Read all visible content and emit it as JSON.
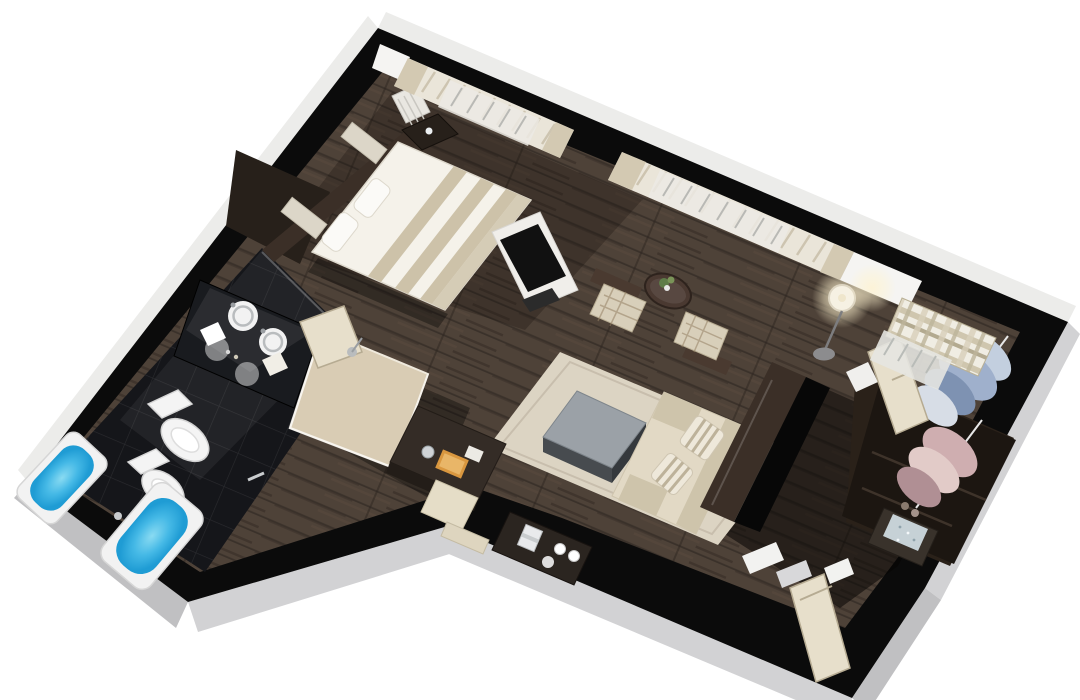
{
  "scene": {
    "description": "3D isometric cutaway floor plan render of a hotel suite apartment, rotated on white background",
    "rooms": [
      {
        "name": "bedroom",
        "furniture": [
          "double-bed-striped-duvet",
          "pillows",
          "headboard-panels",
          "nightstand-with-phone",
          "tv-stand",
          "radiator",
          "window-curtains"
        ]
      },
      {
        "name": "living-room",
        "furniture": [
          "area-rug",
          "coffee-table",
          "cream-sofa",
          "striped-pillows",
          "two-armchairs",
          "round-side-table-with-plant",
          "floor-lamp",
          "writing-desk",
          "desk-chair",
          "coffee-station-console",
          "media-wall-tv",
          "window-curtains"
        ]
      },
      {
        "name": "bathroom",
        "furniture": [
          "large-bathtub",
          "corner-bathtub",
          "toilet",
          "bidet",
          "double-round-sinks-vanity",
          "mirror",
          "towels"
        ]
      },
      {
        "name": "shower-room",
        "furniture": [
          "walk-in-shower",
          "glass-walls",
          "shower-door",
          "shower-head"
        ]
      },
      {
        "name": "dressing-room",
        "furniture": [
          "wardrobe",
          "hanging-blue-shirts",
          "hanging-pink-clothes",
          "safe",
          "plaid-window-curtain",
          "open-door"
        ]
      },
      {
        "name": "entry-hall",
        "furniture": [
          "entry-door",
          "dark-hallway-floor"
        ]
      }
    ]
  },
  "palette": {
    "bg": "#ffffff",
    "wall": "#0b0b0b",
    "face-light": "#ececea",
    "face-mid": "#d2d2d4",
    "face-dark": "#c0c0c2",
    "wood": "#4e4238",
    "wood-line": "#3a312a",
    "wood-light": "#5d4e42",
    "bath-tile": "#15161a",
    "water": "#45b9e6",
    "water-deep": "#1f9cd4",
    "fixture": "#f4f4f4",
    "shower-floor": "#d9ccb4",
    "door-cream": "#e7dfcb",
    "door-edge": "#b6ab92",
    "curtain": "#eae5d9",
    "curtain-fold": "#c8bfaa",
    "drape": "#d3c9b2",
    "white-wall": "#f5f4f2",
    "rug": "#dcd4c3",
    "rug-edge": "#c8bead",
    "sofa": "#e2d9c5",
    "sofa-shade": "#cec4ab",
    "stripe-tan": "#cdc2a9",
    "bed-white": "#f5f2ea",
    "table-top": "#9ba1a7",
    "table-side": "#474b4f",
    "brown-wall": "#3b2f27",
    "brown-dark": "#27201a",
    "lamp-glow": "#fff3cf",
    "orange": "#d9973f",
    "plant": "#5f7c49",
    "clothes-blue": "#9fb0cc",
    "clothes-blue-light": "#c3cfdf",
    "clothes-pink": "#cfaeb0",
    "clothes-pink-light": "#e2cbc8",
    "safe-top": "#c6d1d6",
    "chrome": "#c9ccce"
  }
}
